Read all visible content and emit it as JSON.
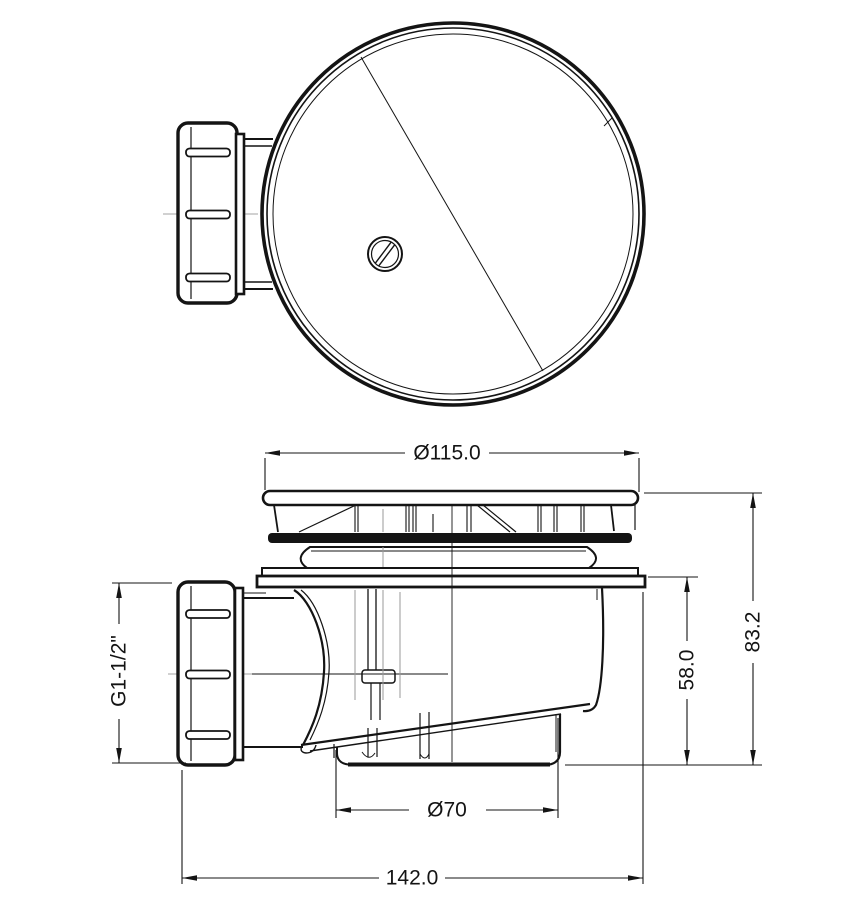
{
  "drawing": {
    "dimensions": {
      "cover_diameter": "Ø115.0",
      "total_height": "83.2",
      "inner_height": "58.0",
      "thread_size": "G1-1/2\"",
      "cup_diameter": "Ø70",
      "total_width": "142.0"
    },
    "colors": {
      "line": "#141414",
      "centerline": "#a3a3a3",
      "hidden_line": "#9a9a9a",
      "background": "#ffffff"
    }
  }
}
